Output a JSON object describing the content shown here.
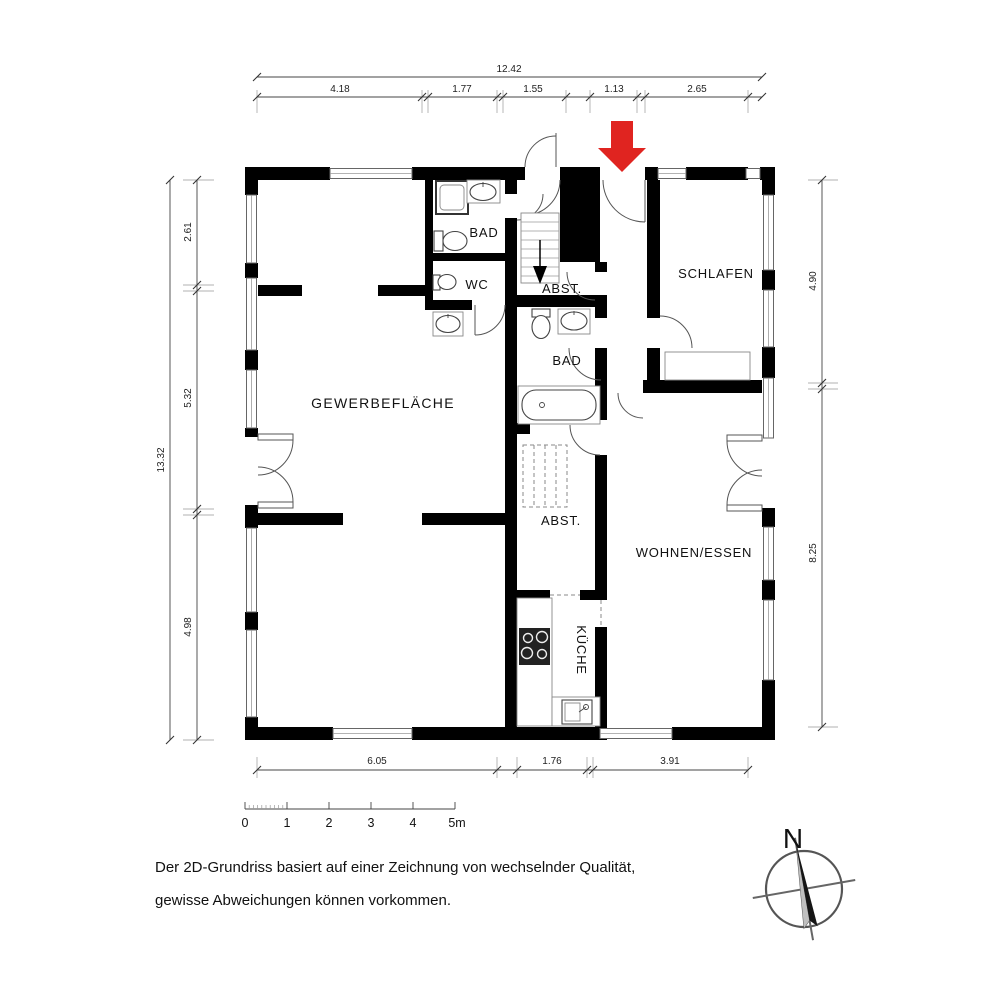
{
  "plan": {
    "rooms": [
      {
        "id": "gewerbeflaeche",
        "label": "GEWERBEFLÄCHE"
      },
      {
        "id": "bad_top",
        "label": "BAD"
      },
      {
        "id": "wc",
        "label": "WC"
      },
      {
        "id": "abst_stairs",
        "label": "ABST."
      },
      {
        "id": "schlafen",
        "label": "SCHLAFEN"
      },
      {
        "id": "bad_mid",
        "label": "BAD"
      },
      {
        "id": "abst_storage",
        "label": "ABST."
      },
      {
        "id": "wohnen_essen",
        "label": "WOHNEN/ESSEN"
      },
      {
        "id": "kueche",
        "label": "KÜCHE"
      }
    ],
    "dimensions": {
      "top_total": "12.42",
      "top_segments": [
        "4.18",
        "1.77",
        "1.55",
        "1.13",
        "2.65"
      ],
      "left_total": "13.32",
      "left_segments": [
        "2.61",
        "5.32",
        "4.98"
      ],
      "right_segments": [
        "4.90",
        "8.25"
      ],
      "bottom_segments": [
        "6.05",
        "1.76",
        "3.91"
      ]
    },
    "scale_bar": {
      "unit_labels": [
        "0",
        "1",
        "2",
        "3",
        "4",
        "5m"
      ]
    },
    "compass": {
      "north_label": "N"
    }
  },
  "disclaimer": {
    "line1": "Der 2D-Grundriss basiert auf einer Zeichnung von wechselnder Qualität,",
    "line2": "gewisse Abweichungen können vorkommen."
  },
  "colors": {
    "wall": "#000000",
    "background": "#ffffff",
    "dimension_line": "#444444",
    "arrow_red": "#e02420"
  }
}
